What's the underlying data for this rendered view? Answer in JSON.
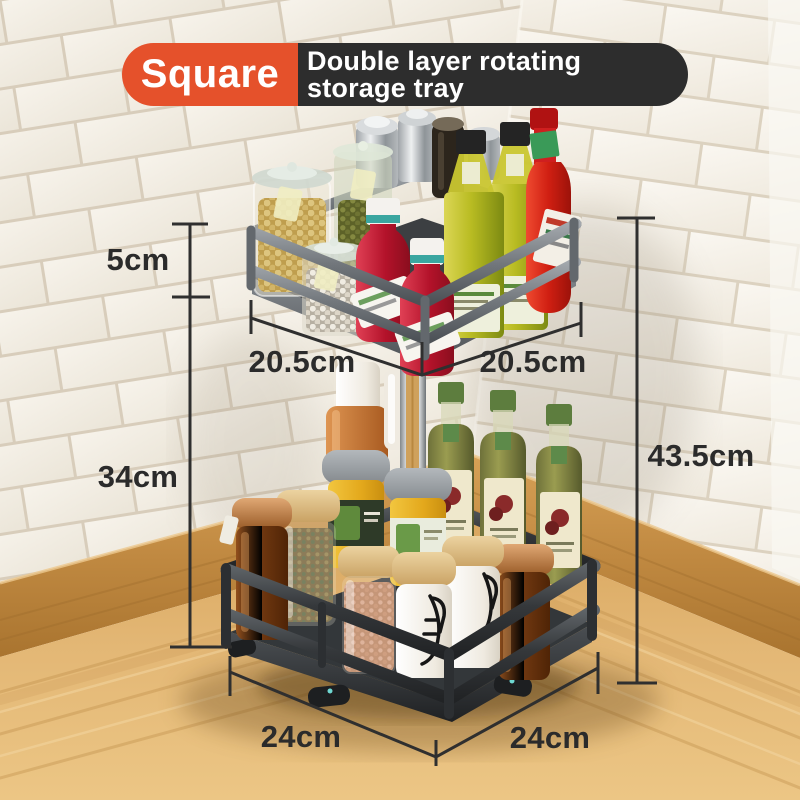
{
  "banner": {
    "badge_label": "Square",
    "title_line1": "Double layer rotating",
    "title_line2": "storage tray"
  },
  "dimensions": {
    "upper_tier_height": "5cm",
    "stand_height": "34cm",
    "upper_tray_side_left": "20.5cm",
    "upper_tray_side_right": "20.5cm",
    "overall_height": "43.5cm",
    "base_side_left": "24cm",
    "base_side_right": "24cm"
  },
  "product": {
    "type": "double-layer-rotating-storage-tray",
    "shape": "square",
    "tiers": 2,
    "upper_tray_items": [
      "steel-shaker",
      "steel-shaker",
      "pepper-grinder",
      "glass-jar-soybeans",
      "glass-jar-green-seeds",
      "glass-jar-pearls",
      "ketchup-bottle",
      "ketchup-bottle",
      "olive-oil-bottle",
      "olive-oil-bottle",
      "hot-sauce-bottle"
    ],
    "lower_tray_items": [
      "sauce-bottle",
      "white-bottle",
      "olive-oil-bottle",
      "olive-oil-bottle",
      "olive-oil-bottle",
      "yellow-spice-jar",
      "yellow-spice-jar",
      "wood-lid-spice-jar",
      "wood-lid-salt-jar",
      "amber-jar-copper-lid",
      "amber-jar-copper-lid",
      "white-clamp-jar",
      "white-clamp-jar"
    ]
  },
  "colors": {
    "accent_orange": "#e5512b",
    "banner_dark": "#2d2d2d",
    "dimension_ink": "#2f2f2f",
    "tile": "#f4f0e8",
    "grout": "#d8cdbb",
    "counter_wood": "#deb26e",
    "baseboard_wood": "#c6914c",
    "tray_silver": "#7d8287",
    "tray_charcoal": "#393c40",
    "chrome_pole": "#c9ccce"
  }
}
